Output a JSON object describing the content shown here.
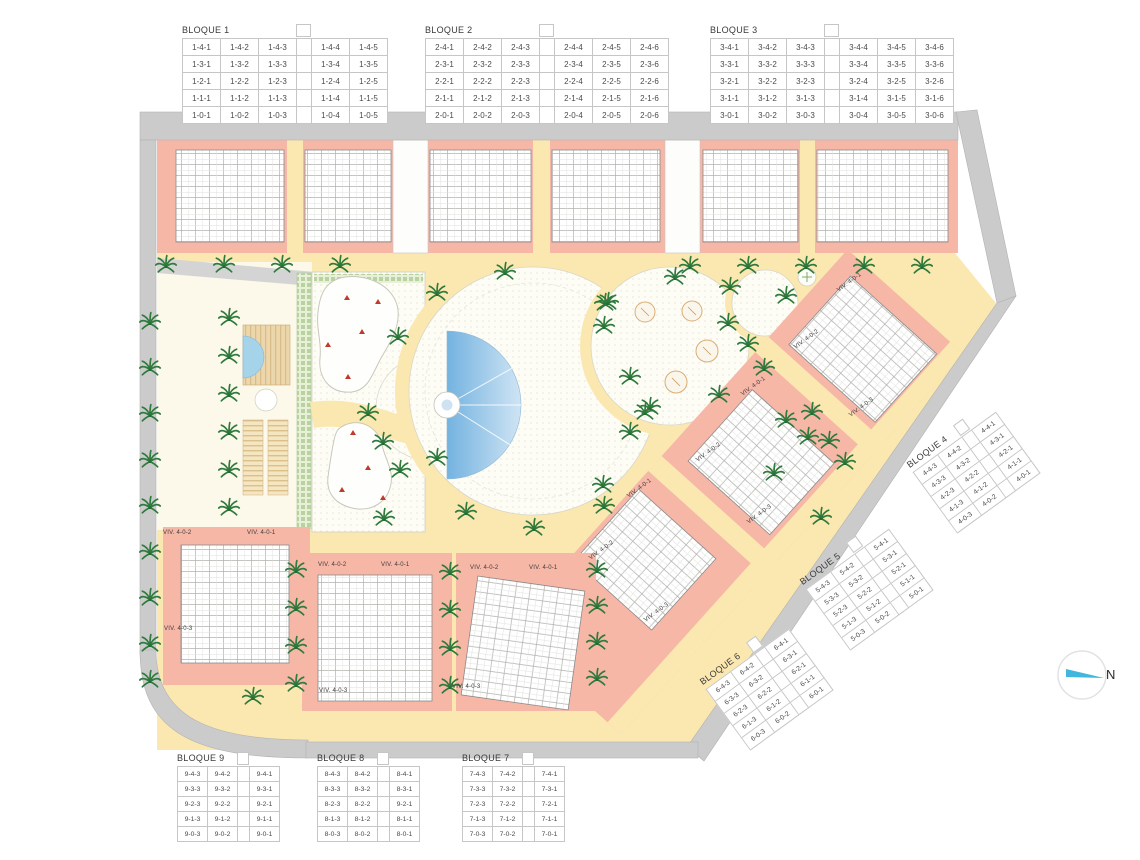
{
  "plan": {
    "compass": {
      "label": "N"
    },
    "colors": {
      "building_fill": "#f6b7a7",
      "path_fill": "#fbe8b0",
      "road_fill": "#cbcbcb",
      "plaza_fill": "#fcf8ea",
      "pool_dark": "#74b3e0",
      "pool_light": "#cfe4f4",
      "palm_green": "#2f7a3d",
      "marker_red": "#c0392b",
      "compass_blue": "#41b7dd"
    },
    "unit_labels": [
      {
        "text": "VIV. 4-0-2",
        "x": 163,
        "y": 530,
        "rot": 0
      },
      {
        "text": "VIV. 4-0-1",
        "x": 247,
        "y": 530,
        "rot": 0
      },
      {
        "text": "VIV. 4-0-3",
        "x": 164,
        "y": 626,
        "rot": 0
      },
      {
        "text": "VIV. 4-0-2",
        "x": 318,
        "y": 562,
        "rot": 0
      },
      {
        "text": "VIV. 4-0-1",
        "x": 381,
        "y": 562,
        "rot": 0
      },
      {
        "text": "VIV. 4-0-3",
        "x": 319,
        "y": 688,
        "rot": 0
      },
      {
        "text": "VIV. 4-0-2",
        "x": 470,
        "y": 565,
        "rot": 0
      },
      {
        "text": "VIV. 4-0-1",
        "x": 529,
        "y": 565,
        "rot": 0
      },
      {
        "text": "VIV. 4-0-3",
        "x": 452,
        "y": 684,
        "rot": 0
      },
      {
        "text": "VIV. 4-0-1",
        "x": 838,
        "y": 288,
        "rot": -36
      },
      {
        "text": "VIV. 4-0-2",
        "x": 795,
        "y": 345,
        "rot": -36
      },
      {
        "text": "VIV. 4-0-3",
        "x": 850,
        "y": 413,
        "rot": -36
      },
      {
        "text": "VIV. 4-0-1",
        "x": 742,
        "y": 392,
        "rot": -36
      },
      {
        "text": "VIV. 4-0-2",
        "x": 697,
        "y": 458,
        "rot": -36
      },
      {
        "text": "VIV. 4-0-3",
        "x": 748,
        "y": 520,
        "rot": -36
      },
      {
        "text": "VIV. 4-0-1",
        "x": 628,
        "y": 494,
        "rot": -36
      },
      {
        "text": "VIV. 4-0-2",
        "x": 590,
        "y": 556,
        "rot": -36
      },
      {
        "text": "VIV. 4-0-3",
        "x": 645,
        "y": 618,
        "rot": -36
      }
    ],
    "palms": [
      [
        166,
        265
      ],
      [
        224,
        265
      ],
      [
        282,
        265
      ],
      [
        340,
        265
      ],
      [
        690,
        266
      ],
      [
        748,
        266
      ],
      [
        806,
        266
      ],
      [
        864,
        266
      ],
      [
        922,
        266
      ],
      [
        150,
        322
      ],
      [
        150,
        368
      ],
      [
        150,
        414
      ],
      [
        150,
        460
      ],
      [
        150,
        506
      ],
      [
        150,
        552
      ],
      [
        150,
        598
      ],
      [
        150,
        644
      ],
      [
        150,
        680
      ],
      [
        229,
        318
      ],
      [
        229,
        356
      ],
      [
        229,
        394
      ],
      [
        229,
        432
      ],
      [
        229,
        470
      ],
      [
        229,
        508
      ],
      [
        398,
        337
      ],
      [
        368,
        413
      ],
      [
        383,
        442
      ],
      [
        400,
        470
      ],
      [
        384,
        518
      ],
      [
        437,
        293
      ],
      [
        505,
        272
      ],
      [
        605,
        303
      ],
      [
        437,
        458
      ],
      [
        466,
        512
      ],
      [
        534,
        528
      ],
      [
        604,
        506
      ],
      [
        675,
        277
      ],
      [
        608,
        302
      ],
      [
        604,
        326
      ],
      [
        730,
        287
      ],
      [
        786,
        296
      ],
      [
        728,
        323
      ],
      [
        748,
        344
      ],
      [
        630,
        377
      ],
      [
        645,
        412
      ],
      [
        719,
        395
      ],
      [
        764,
        368
      ],
      [
        812,
        412
      ],
      [
        650,
        407
      ],
      [
        630,
        432
      ],
      [
        603,
        485
      ],
      [
        786,
        420
      ],
      [
        808,
        437
      ],
      [
        829,
        441
      ],
      [
        774,
        473
      ],
      [
        821,
        517
      ],
      [
        845,
        462
      ],
      [
        296,
        570
      ],
      [
        296,
        608
      ],
      [
        296,
        646
      ],
      [
        296,
        684
      ],
      [
        450,
        572
      ],
      [
        450,
        610
      ],
      [
        450,
        648
      ],
      [
        450,
        686
      ],
      [
        597,
        570
      ],
      [
        597,
        606
      ],
      [
        597,
        642
      ],
      [
        597,
        678
      ],
      [
        253,
        697
      ]
    ],
    "red_markers": [
      [
        347,
        298
      ],
      [
        378,
        302
      ],
      [
        362,
        332
      ],
      [
        328,
        345
      ],
      [
        348,
        377
      ],
      [
        353,
        433
      ],
      [
        368,
        468
      ],
      [
        342,
        490
      ],
      [
        383,
        498
      ]
    ]
  },
  "tables": [
    {
      "title": "BLOQUE 1",
      "gap_after": 3,
      "rows": [
        [
          "1-4-1",
          "1-4-2",
          "1-4-3",
          "1-4-4",
          "1-4-5"
        ],
        [
          "1-3-1",
          "1-3-2",
          "1-3-3",
          "1-3-4",
          "1-3-5"
        ],
        [
          "1-2-1",
          "1-2-2",
          "1-2-3",
          "1-2-4",
          "1-2-5"
        ],
        [
          "1-1-1",
          "1-1-2",
          "1-1-3",
          "1-1-4",
          "1-1-5"
        ],
        [
          "1-0-1",
          "1-0-2",
          "1-0-3",
          "1-0-4",
          "1-0-5"
        ]
      ]
    },
    {
      "title": "BLOQUE 2",
      "gap_after": 3,
      "rows": [
        [
          "2-4-1",
          "2-4-2",
          "2-4-3",
          "2-4-4",
          "2-4-5",
          "2-4-6"
        ],
        [
          "2-3-1",
          "2-3-2",
          "2-3-3",
          "2-3-4",
          "2-3-5",
          "2-3-6"
        ],
        [
          "2-2-1",
          "2-2-2",
          "2-2-3",
          "2-2-4",
          "2-2-5",
          "2-2-6"
        ],
        [
          "2-1-1",
          "2-1-2",
          "2-1-3",
          "2-1-4",
          "2-1-5",
          "2-1-6"
        ],
        [
          "2-0-1",
          "2-0-2",
          "2-0-3",
          "2-0-4",
          "2-0-5",
          "2-0-6"
        ]
      ]
    },
    {
      "title": "BLOQUE 3",
      "gap_after": 3,
      "rows": [
        [
          "3-4-1",
          "3-4-2",
          "3-4-3",
          "3-4-4",
          "3-4-5",
          "3-4-6"
        ],
        [
          "3-3-1",
          "3-3-2",
          "3-3-3",
          "3-3-4",
          "3-3-5",
          "3-3-6"
        ],
        [
          "3-2-1",
          "3-2-2",
          "3-2-3",
          "3-2-4",
          "3-2-5",
          "3-2-6"
        ],
        [
          "3-1-1",
          "3-1-2",
          "3-1-3",
          "3-1-4",
          "3-1-5",
          "3-1-6"
        ],
        [
          "3-0-1",
          "3-0-2",
          "3-0-3",
          "3-0-4",
          "3-0-5",
          "3-0-6"
        ]
      ]
    },
    {
      "title": "BLOQUE 4",
      "gap_after": 2,
      "rows": [
        [
          "4-4-3",
          "4-4-2",
          "4-4-1"
        ],
        [
          "4-3-3",
          "4-3-2",
          "4-3-1"
        ],
        [
          "4-2-3",
          "4-2-2",
          "4-2-1"
        ],
        [
          "4-1-3",
          "4-1-2",
          "4-1-1"
        ],
        [
          "4-0-3",
          "4-0-2",
          "4-0-1"
        ]
      ]
    },
    {
      "title": "BLOQUE 5",
      "gap_after": 2,
      "rows": [
        [
          "5-4-3",
          "5-4-2",
          "5-4-1"
        ],
        [
          "5-3-3",
          "5-3-2",
          "5-3-1"
        ],
        [
          "5-2-3",
          "5-2-2",
          "5-2-1"
        ],
        [
          "5-1-3",
          "5-1-2",
          "5-1-1"
        ],
        [
          "5-0-3",
          "5-0-2",
          "5-0-1"
        ]
      ]
    },
    {
      "title": "BLOQUE 6",
      "gap_after": 2,
      "rows": [
        [
          "6-4-3",
          "6-4-2",
          "6-4-1"
        ],
        [
          "6-3-3",
          "6-3-2",
          "6-3-1"
        ],
        [
          "6-2-3",
          "6-2-2",
          "6-2-1"
        ],
        [
          "6-1-3",
          "6-1-2",
          "6-1-1"
        ],
        [
          "6-0-3",
          "6-0-2",
          "6-0-1"
        ]
      ]
    },
    {
      "title": "BLOQUE 7",
      "gap_after": 2,
      "rows": [
        [
          "7-4-3",
          "7-4-2",
          "7-4-1"
        ],
        [
          "7-3-3",
          "7-3-2",
          "7-3-1"
        ],
        [
          "7-2-3",
          "7-2-2",
          "7-2-1"
        ],
        [
          "7-1-3",
          "7-1-2",
          "7-1-1"
        ],
        [
          "7-0-3",
          "7-0-2",
          "7-0-1"
        ]
      ]
    },
    {
      "title": "BLOQUE 8",
      "gap_after": 2,
      "rows": [
        [
          "8-4-3",
          "8-4-2",
          "8-4-1"
        ],
        [
          "8-3-3",
          "8-3-2",
          "8-3-1"
        ],
        [
          "8-2-3",
          "8-2-2",
          "9-2-1"
        ],
        [
          "8-1-3",
          "8-1-2",
          "8-1-1"
        ],
        [
          "8-0-3",
          "8-0-2",
          "8-0-1"
        ]
      ]
    },
    {
      "title": "BLOQUE 9",
      "gap_after": 2,
      "rows": [
        [
          "9-4-3",
          "9-4-2",
          "9-4-1"
        ],
        [
          "9-3-3",
          "9-3-2",
          "9-3-1"
        ],
        [
          "9-2-3",
          "9-2-2",
          "9-2-1"
        ],
        [
          "9-1-3",
          "9-1-2",
          "9-1-1"
        ],
        [
          "9-0-3",
          "9-0-2",
          "9-0-1"
        ]
      ]
    }
  ]
}
